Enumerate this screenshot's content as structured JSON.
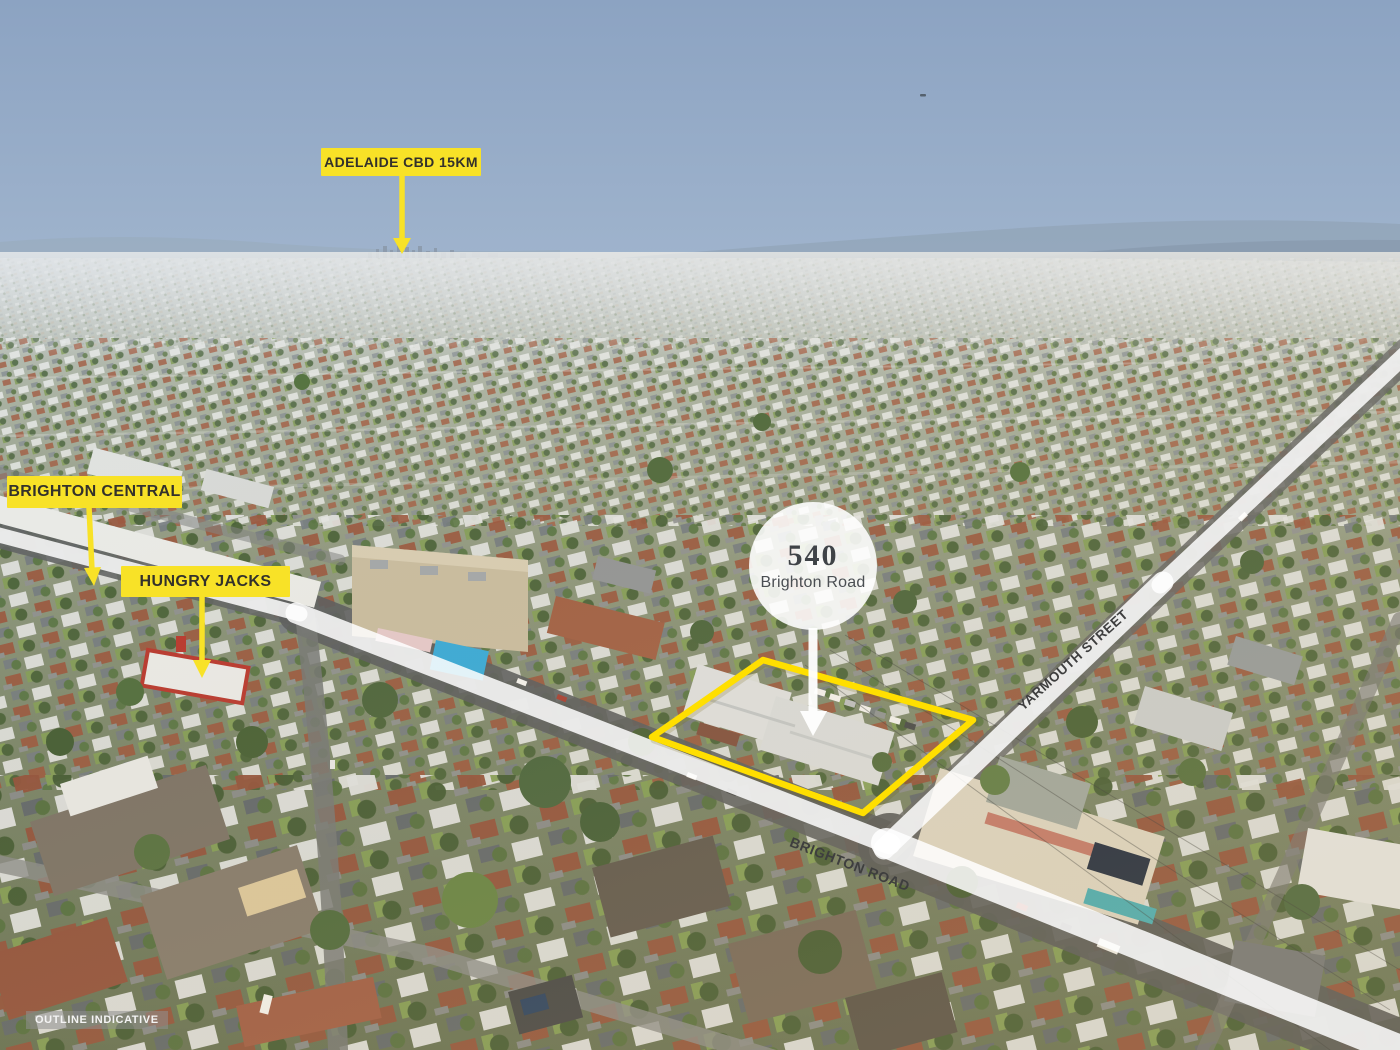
{
  "callouts": {
    "adelaide_cbd": "ADELAIDE CBD 15KM",
    "brighton_central": "BRIGHTON CENTRAL",
    "hungry_jacks": "HUNGRY JACKS"
  },
  "property_badge": {
    "number": "540",
    "street": "Brighton Road"
  },
  "road_labels": {
    "brighton_road": "BRIGHTON ROAD",
    "yarmouth_street": "YARMOUTH STREET"
  },
  "disclaimer_label": "OUTLINE INDICATIVE",
  "icons": {
    "callout_arrows": "arrow-down",
    "badge_pointer": "arrow-down",
    "property_outline": "quadrilateral-outline"
  },
  "colors": {
    "callout_yellow": "#F8E227",
    "property_outline_yellow": "#FFDF00",
    "road_overlay_white": "#FFFFFF",
    "callout_text": "#33312B",
    "badge_text": "#3F4347",
    "road_label_text": "#3E3E3E",
    "badge_background": "#FFFFFF",
    "disclaimer_background": "#8F8F8F",
    "disclaimer_text": "#F4F4F4",
    "sky_top": "#8CA3C2",
    "sky_horizon": "#DDE2E6"
  }
}
